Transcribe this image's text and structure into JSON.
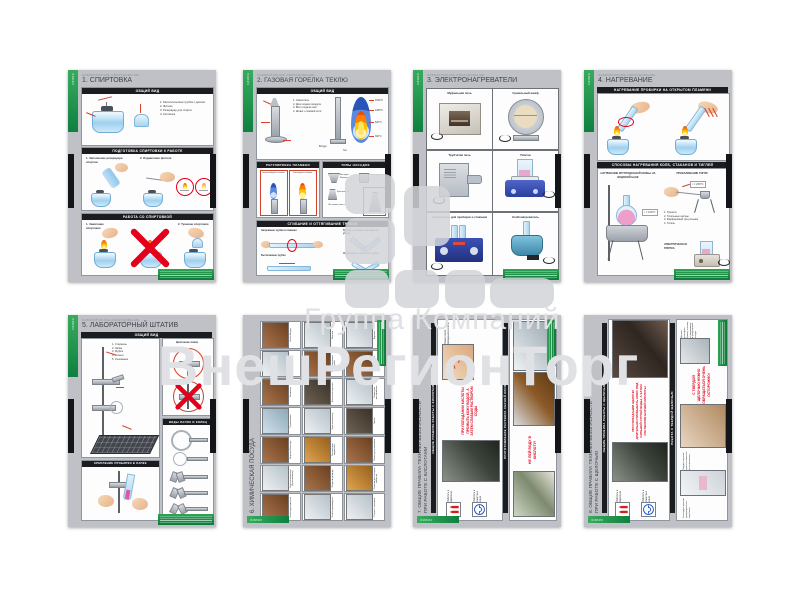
{
  "watermark": {
    "line1": "Группа Компаний",
    "line2": "ВнешРегионТорг"
  },
  "common": {
    "series_caption": "ЛАБОРАТОРНОЕ ОБОРУДОВАНИЕ",
    "edge_label": "ХИМИЯ"
  },
  "colors": {
    "green": "#1f9447",
    "band_black": "#1b1c1f",
    "warning_red": "#e2001a",
    "poster_gray": "#bfc1c6"
  },
  "posters": [
    {
      "title": "1. СПИРТОВКА",
      "s1": {
        "band": "ОБЩИЙ ВИД",
        "parts": [
          "1. Металлическая трубка с диском",
          "2. Фитиль",
          "3. Резервуар для спирта",
          "4. Колпачок"
        ]
      },
      "s2": {
        "band": "ПОДГОТОВКА СПИРТОВКИ К РАБОТЕ",
        "item1": "1. Заполнение резервуара спиртом",
        "item2": "2. Поджигание фитиля"
      },
      "s3": {
        "band": "РАБОТА СО СПИРТОВКОЙ",
        "item1": "1. Зажигание спиртовки",
        "item2": "2. Тушение спиртовки"
      }
    },
    {
      "title": "2. ГАЗОВАЯ ГОРЕЛКА ТЕКЛЮ",
      "s1": {
        "band": "ОБЩИЙ ВИД",
        "parts": [
          "1. Смеситель",
          "2. Диск подачи воздуха",
          "3. Винт подачи газа",
          "4. Шланг к газовой сети"
        ],
        "temps": [
          "1540°C",
          "1280°C",
          "520°C",
          "300°C"
        ],
        "air": "Воздух",
        "gas": "Газ"
      },
      "s2": {
        "band": "РЕГУЛИРОВКА ПЛАМЕНИ",
        "flame1": "Несветящееся пламя",
        "flame2": "Светящееся пламя"
      },
      "s3": {
        "band": "ТИПЫ НАСАДОК",
        "n1": "Насадка Мекера",
        "n2": "Кисточковая",
        "n3": "Крыльчатая",
        "n4": "Ласточкин хвост"
      },
      "s4": {
        "band": "СГИБАНИЕ И ОТТЯГИВАНИЕ ТРУБОК",
        "i1": "Нагревание трубки в пламени",
        "i2": "Вытягивание трубки",
        "i3": "Трубка, согнутая под прямым углом",
        "i4": "Неправильно согнутая трубка"
      }
    },
    {
      "title": "3. ЭЛЕКТРОНАГРЕВАТЕЛИ",
      "cells": [
        "Муфельная печь",
        "Сушильный шкаф",
        "Трубчатая печь",
        "Плитка",
        "Нагреватель для пробирок и стаканов",
        "Колбонагреватель"
      ]
    },
    {
      "title": "4. НАГРЕВАНИЕ",
      "band1": "НАГРЕВАНИЕ ПРОБИРКИ НА ОТКРЫТОМ ПЛАМЕНИ",
      "band2": "СПОСОБЫ НАГРЕВАНИЯ КОЛБ, СТАКАНОВ И ТИГЛЕЙ",
      "sub1": "НАГРЕВАНИЕ КРУГЛОДОННОЙ КОЛБЫ НА ВОДЯНОЙ БАНЕ",
      "temp1": "t = 100°C",
      "sub2": "ПРОКАЛИВАНИЕ ТИГЛЯ",
      "temp2": "t = 200°C",
      "parts": [
        "1. Тренога",
        "2. Тигельные щипцы",
        "3. Фарфоровый треугольник",
        "4. Тигель"
      ],
      "sub3": "ЭЛЕКТРИЧЕСКАЯ ПЛИТКА"
    },
    {
      "title": "5. ЛАБОРАТОРНЫЙ ШТАТИВ",
      "band1": "ОБЩИЙ ВИД",
      "parts": [
        "1. Стержень",
        "2. Лапка",
        "3. Муфта",
        "4. Кольцо",
        "5. Основание"
      ],
      "sub1": "Крепление лапки",
      "band2": "ВИДЫ ЛАПОК И КОЛЕЦ",
      "band3": "КРЕПЛЕНИЕ ПРОБИРКИ В ЛАПКЕ"
    },
    {
      "title": "6. ХИМИЧЕСКАЯ ПОСУДА",
      "items": [
        "Колба круглодонная",
        "Колба коническая (Эрленмейера)",
        "Воронка Бюхнера",
        "Промывалка",
        "Эксикатор",
        "Стакан",
        "Колба Вюрца",
        "Колба грушевидная",
        "Мерный цилиндр",
        "Склянки для жидкостей",
        "Кристаллизатор",
        "Капельная воронка",
        "Хлоркальциевая трубка",
        "Аллонж",
        "Ступка с пестиком",
        "Склянки для сыпучих веществ",
        "Банка для реактивов",
        "Тигель",
        "Чашка для выпаривания",
        "Аппарат Киппа",
        "Воронка"
      ]
    },
    {
      "title1": "7. ОБЩИЕ ПРАВИЛА ТЕХНИКИ БЕЗОПАСНОСТИ",
      "title2": "ПРИ РАБОТЕ С КИСЛОТАМИ",
      "band1": "ОБЩИЕ ПРАВИЛА РАБОТЫ С КИСЛОТАМИ",
      "gloves": "Работать в перчатках",
      "goggles": "Работать в защитных очках",
      "warning1": "ПРИ ПОПАДАНИИ КИСЛОТЫ ПРОМЫТЬ КОЖУ ВОДОЙ, А ЗАТЕМ СЛАБЫМ РАСТВОРОМ СОДЫ",
      "caption1": "Ожоги после попадания кислоты",
      "band2": "ПРИГОТОВЛЕНИЕ РАСТВОРА СЕРНОЙ КИСЛОТЫ",
      "warning2": "НЕ ЛЕЙ ВОДУ В КИСЛОТУ!"
    },
    {
      "title1": "8. ОБЩИЕ ПРАВИЛА ТЕХНИКИ БЕЗОПАСНОСТИ",
      "title2": "ПРИ РАБОТЕ С ЩЕЛОЧЬЮ",
      "band1": "ОБЩИЕ ПРАВИЛА РАБОТЫ С ЩЕЛОЧЬЮ",
      "gloves": "Работать в перчатках",
      "goggles": "Работать в защитных очках",
      "warning1": "ПРИ ПОПАДАНИИ ЩЕЛОЧИ ДЛИТЕЛЬНО ПРОМЫВАТЬ КОЖУ ПОД СИЛЬНОЙ СТРУЕЙ ВОДЫ, А ЗАТЕМ РАСТВОРОМ БОРНОЙ КИСЛОТЫ",
      "band2": "РАБОТА С ТВЕРДОЙ ЩЕЛОЧЬЮ",
      "warning2": "С ТВЕРДОЙ ЩЕЛОЧЬЮ НУЖНО ОБРАЩАТЬСЯ ОЧЕНЬ ОСТОРОЖНО!",
      "caption1": "Щелочь разъедает бумагу, поэтому ее взвешивают в фарфоровой посуде",
      "caption2": "Твердые щелочи хранят в емкостях из полиэтилена",
      "caption3": "На воздухе щелочи превращаются в карбонаты"
    }
  ]
}
